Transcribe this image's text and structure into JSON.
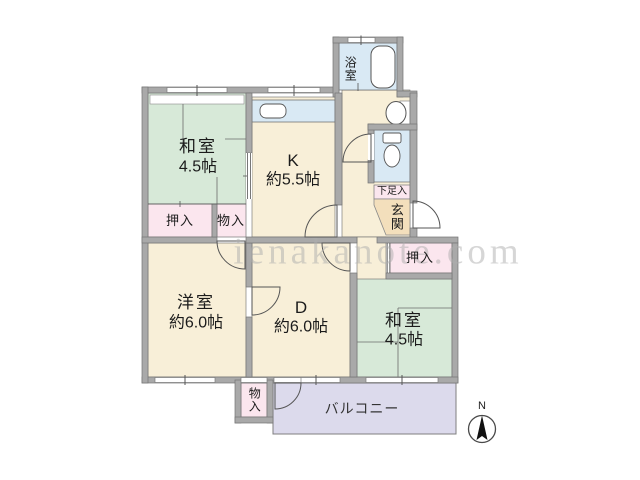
{
  "watermark": "ienakanote.com",
  "colors": {
    "tatami_green": "#d7e9d8",
    "room_cream": "#f8efd8",
    "closet_pink": "#fbe6ee",
    "wet_area_blue": "#d9e9f4",
    "genkan_tan": "#f3dfbc",
    "balcony_lavender": "#dcdaec",
    "wall_gray": "#a9a9a9"
  },
  "rooms": {
    "washitsu_top": {
      "name": "和室",
      "size": "4.5帖"
    },
    "kitchen": {
      "name": "K",
      "size": "約5.5帖"
    },
    "western": {
      "name": "洋室",
      "size": "約6.0帖"
    },
    "dining": {
      "name": "D",
      "size": "約6.0帖"
    },
    "washitsu_right": {
      "name": "和室",
      "size": "4.5帖"
    },
    "bath": {
      "name": "浴室"
    },
    "genkan": {
      "name": "玄関"
    }
  },
  "storage": {
    "oshiire_left": "押入",
    "monoire_left": "物入",
    "oshiire_right": "押入",
    "getabako": "下足入",
    "monoire_bottom": "物入"
  },
  "outdoor": {
    "balcony": "バルコニー"
  },
  "compass": {
    "north": "N"
  }
}
